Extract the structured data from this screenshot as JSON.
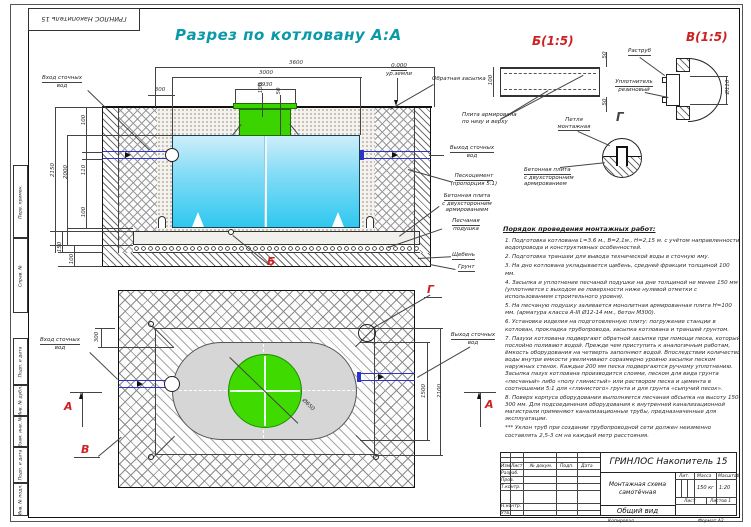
{
  "frame": {
    "corner_stamp": "ГРИНЛОС Накопитель 15",
    "strip": [
      "Перв. примен.",
      "Справ. №",
      "Подп. и дата",
      "Инв. № дубл.",
      "Взам. инв. №",
      "Подп. и дата",
      "Инв. № подл."
    ]
  },
  "section": {
    "title": "Разрез по котловану А:А",
    "inlet_l1": "Вход сточных",
    "inlet_l2": "вод",
    "outlet_l1": "Выход сточных",
    "outlet_l2": "вод",
    "backfill": "Обратная засыпка",
    "level": "0.000",
    "level2": "ур.земли",
    "sandcement_l1": "Пескоцемент",
    "sandcement_l2": "(пропорция 5:1)",
    "slab_l1": "Бетонная плита",
    "slab_l2": "с двухсторонним",
    "slab_l3": "армированием",
    "cushion_l1": "Песчаная",
    "cushion_l2": "подушка",
    "gravel": "Щебень",
    "soil": "Грунт",
    "marker_b": "Б",
    "dim_3600": "3600",
    "dim_3000": "3000",
    "dim_neck": "Ø930",
    "dim_300": "300",
    "dim_100t": "100",
    "dim_50": "50",
    "dim_2150": "2150",
    "dim_2000": "2000",
    "dim_110": "110",
    "dim_100l": "100",
    "dim_100b": "100",
    "dim_150": "150",
    "dim_100s": "100"
  },
  "plan": {
    "inlet_l1": "Вход сточных",
    "inlet_l2": "вод",
    "outlet_l1": "Выход сточных",
    "outlet_l2": "вод",
    "marker_a_left": "A",
    "marker_a_right": "A",
    "marker_v": "В",
    "marker_g": "Г",
    "dim_300": "300",
    "dim_1500": "1500",
    "dim_2100": "2100",
    "dim_650": "Ø650"
  },
  "details": {
    "b_title": "Б(1:5)",
    "b_note1": "Плита армирована",
    "b_note2": "по низу и верху",
    "b_100": "100",
    "b_50a": "50",
    "b_50b": "50",
    "v_title": "В(1:5)",
    "v_socket": "Раструб",
    "v_seal1": "Уплотнитель",
    "v_seal2": "резиновый",
    "v_dim": "Ø110",
    "g_title": "Г",
    "g_loop1": "Петля",
    "g_loop2": "монтажная",
    "g_slab1": "Бетонная плита",
    "g_slab2": "с двухсторонним",
    "g_slab3": "армированием"
  },
  "notes": {
    "title": "Порядок проведения монтажных работ:",
    "items": [
      "1. Подготовка котлована L=3.6 м., B=2,1м., H=2,15 м. с учётом направленности водопровода и конструктивных особенностей.",
      "2. Подготовка траншеи для вывода технической воды в сточную яму.",
      "3. На дно котлована укладывается щебень, средней фракции толщиной 100 мм.",
      "4. Засыпка и уплотнение песчаной подушки на дне толщиной не менее 150 мм (уплотняется с выходом ее поверхности ниже нулевой отметки с использованием строительного уровня).",
      "5. На песчаную подушку заливается монолитная армированная плита Н=100 мм. (арматура класса А-III Ø12-14 мм., бетон М300).",
      "6. Установка изделия на подготовленную плиту: погружение станции в котлован, прокладка трубопровода, засыпка котлована и траншей грунтом.",
      "7. Пазухи котлована подвергают обратной засыпке при помощи песка, который послойно поливают водой. Прежде чем приступить к аналогичным работам, ёмкость оборудования на четверть заполняют водой. Впоследствии количество воды внутри емкости увеличивают соразмерно уровню засыпки песком наружных стенок. Каждые 200 мм песка подвергаются ручному уплотнению. Засыпка пазух котлована производится слоями, песком для вида грунта «песчаный» либо «полу глинистый» или раствором песка и цемента в соотношении 5:1 для «глинистого» грунта и для грунта «сыпучий песок».",
      "8. Поверх корпуса оборудования выполняется песчаная обсыпка на высоту 150-300 мм. Для подсоединения оборудования к внутренней канализационной магистрали применяют канализационные трубы, предназначенные для эксплуатации.",
      "*** Уклон труб при создании трубопроводной сети должен неизменно составлять 2,5-3 см на каждый метр расстояния."
    ]
  },
  "titleblock": {
    "doc": "ГРИНЛОС Накопитель 15",
    "name1": "Монтажная схема",
    "name2": "самотёчная",
    "view": "Общий вид",
    "h_izm": "Изм.",
    "h_list": "Лист",
    "h_doc": "№ докум.",
    "h_sign": "Подп.",
    "h_date": "Дата",
    "r1": "Разраб.",
    "r2": "Пров.",
    "r3": "Т.контр.",
    "r4": "Н.контр.",
    "r5": "Утв.",
    "lit": "Лит.",
    "mass": "Масса",
    "scale": "Масштаб",
    "mass_v": "150 кг",
    "scale_v": "1:20",
    "sheet": "Лист",
    "sheets": "Листов 1",
    "copy": "Копировал",
    "format": "Формат А2"
  },
  "colors": {
    "accent_teal": "#0a99a8",
    "marker_red": "#cc2222",
    "tank_blue": "#2fc8ef",
    "green": "#3bd400",
    "pipe_blue": "#2a35c8"
  }
}
